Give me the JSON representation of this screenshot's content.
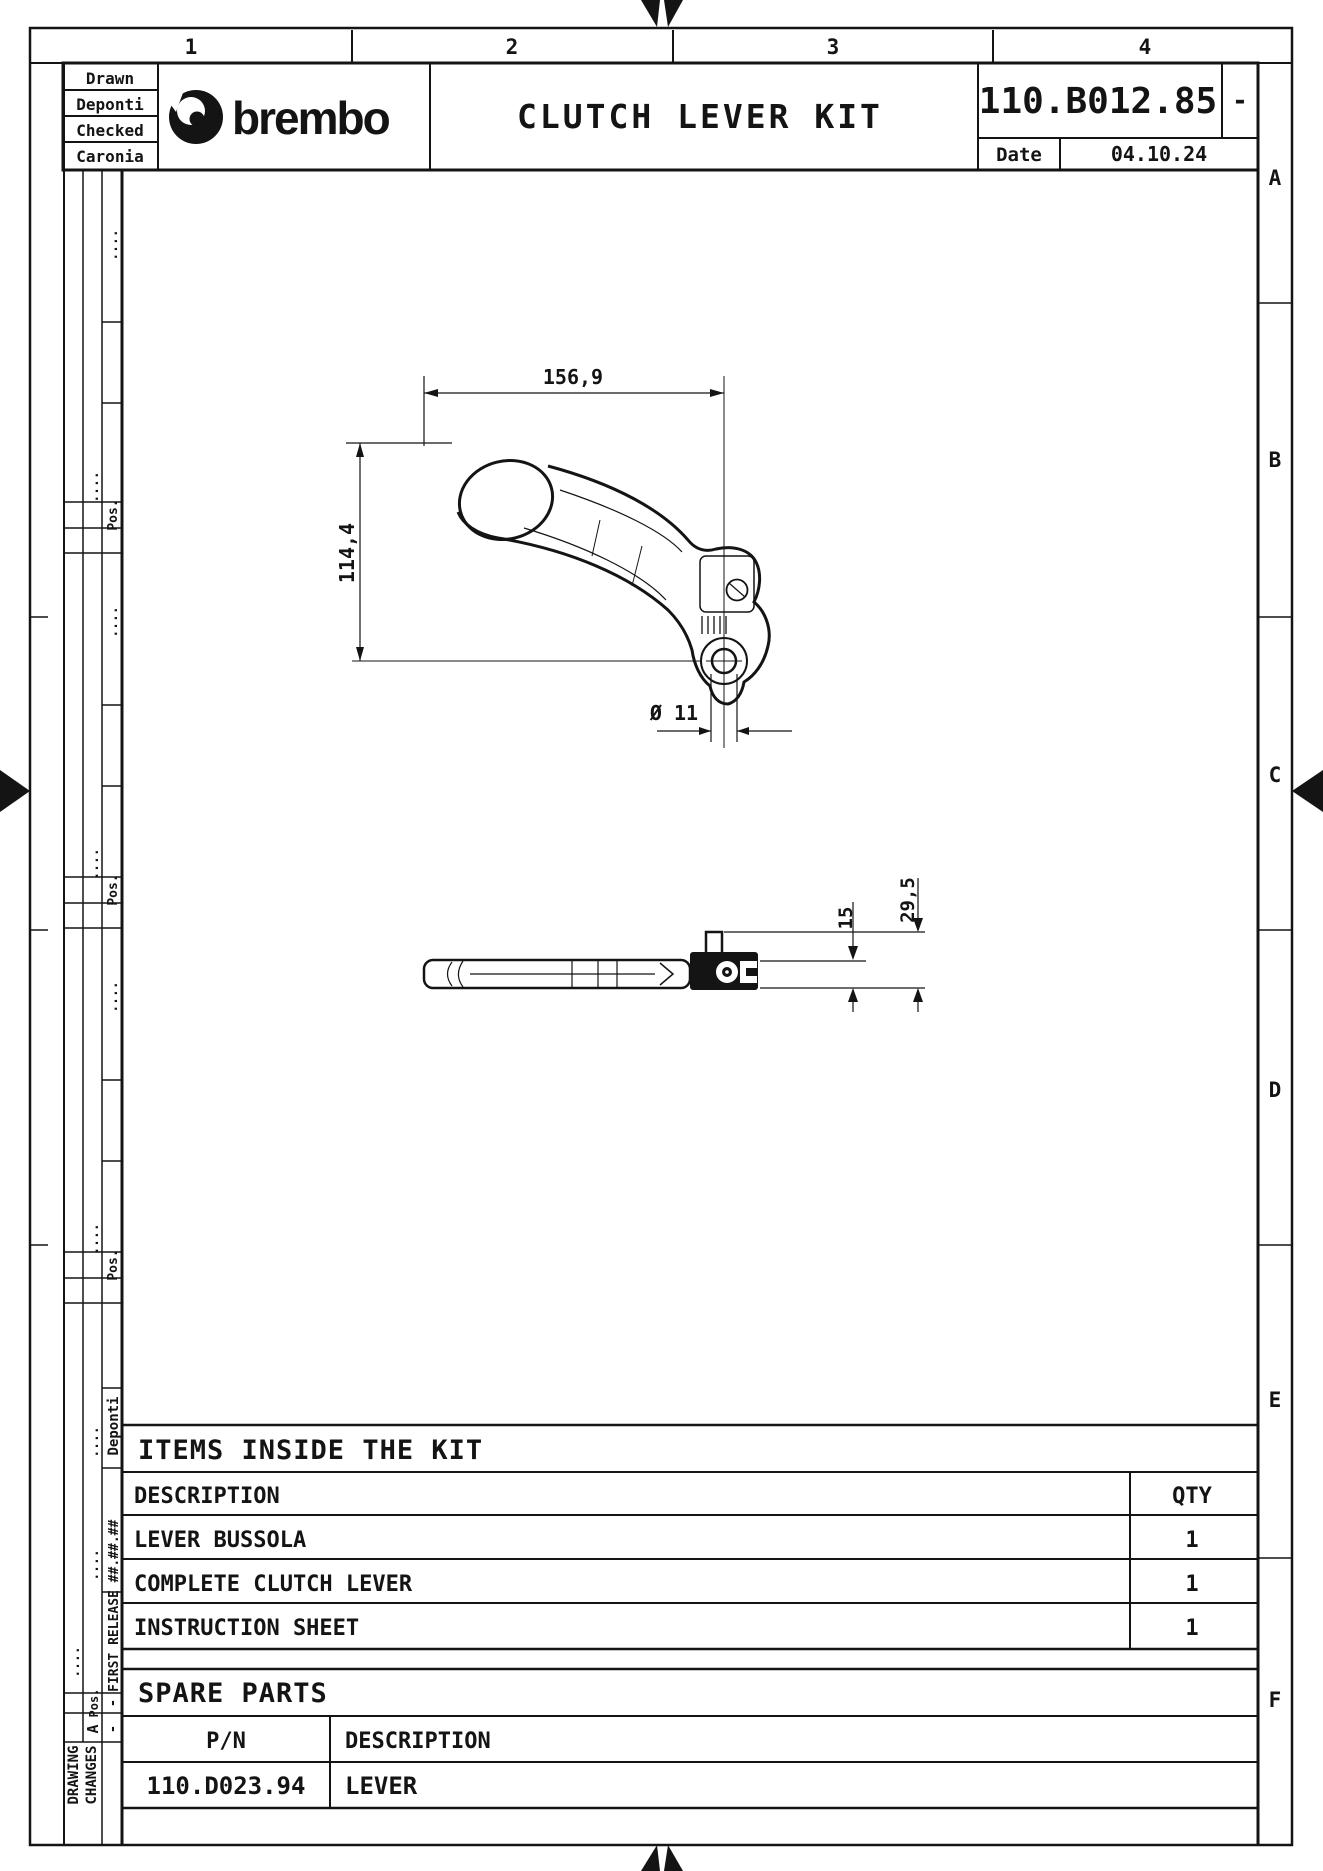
{
  "meta": {
    "sheet_columns": [
      "1",
      "2",
      "3",
      "4"
    ],
    "sheet_rows": [
      "A",
      "B",
      "C",
      "D",
      "E",
      "F"
    ]
  },
  "title_block": {
    "drawn_label": "Drawn",
    "drawn_name": "Deponti",
    "checked_label": "Checked",
    "checked_name": "Caronia",
    "brand": "brembo",
    "title": "CLUTCH LEVER KIT",
    "part_number": "110.B012.85",
    "revision": "-",
    "date_label": "Date",
    "date_value": "04.10.24"
  },
  "dimensions": {
    "front_width": "156,9",
    "front_height": "114,4",
    "hole_diameter": "Ø 11",
    "side_thickness": "15",
    "side_total": "29,5"
  },
  "revision_strip": {
    "pos_label": "Pos.",
    "row_letter": "A",
    "dash": "-",
    "first_release": "FIRST RELEASE",
    "date_mask": "##.##.##",
    "drawn_name": "Deponti",
    "dots": "....",
    "changes_line1": "DRAWING",
    "changes_line2": "CHANGES"
  },
  "items_table": {
    "title": "ITEMS INSIDE THE KIT",
    "col_description": "DESCRIPTION",
    "col_qty": "QTY",
    "rows": [
      {
        "description": "LEVER BUSSOLA",
        "qty": "1"
      },
      {
        "description": "COMPLETE CLUTCH LEVER",
        "qty": "1"
      },
      {
        "description": "INSTRUCTION SHEET",
        "qty": "1"
      }
    ]
  },
  "spare_parts": {
    "title": "SPARE PARTS",
    "col_pn": "P/N",
    "col_description": "DESCRIPTION",
    "rows": [
      {
        "pn": "110.D023.94",
        "description": "LEVER"
      }
    ]
  }
}
